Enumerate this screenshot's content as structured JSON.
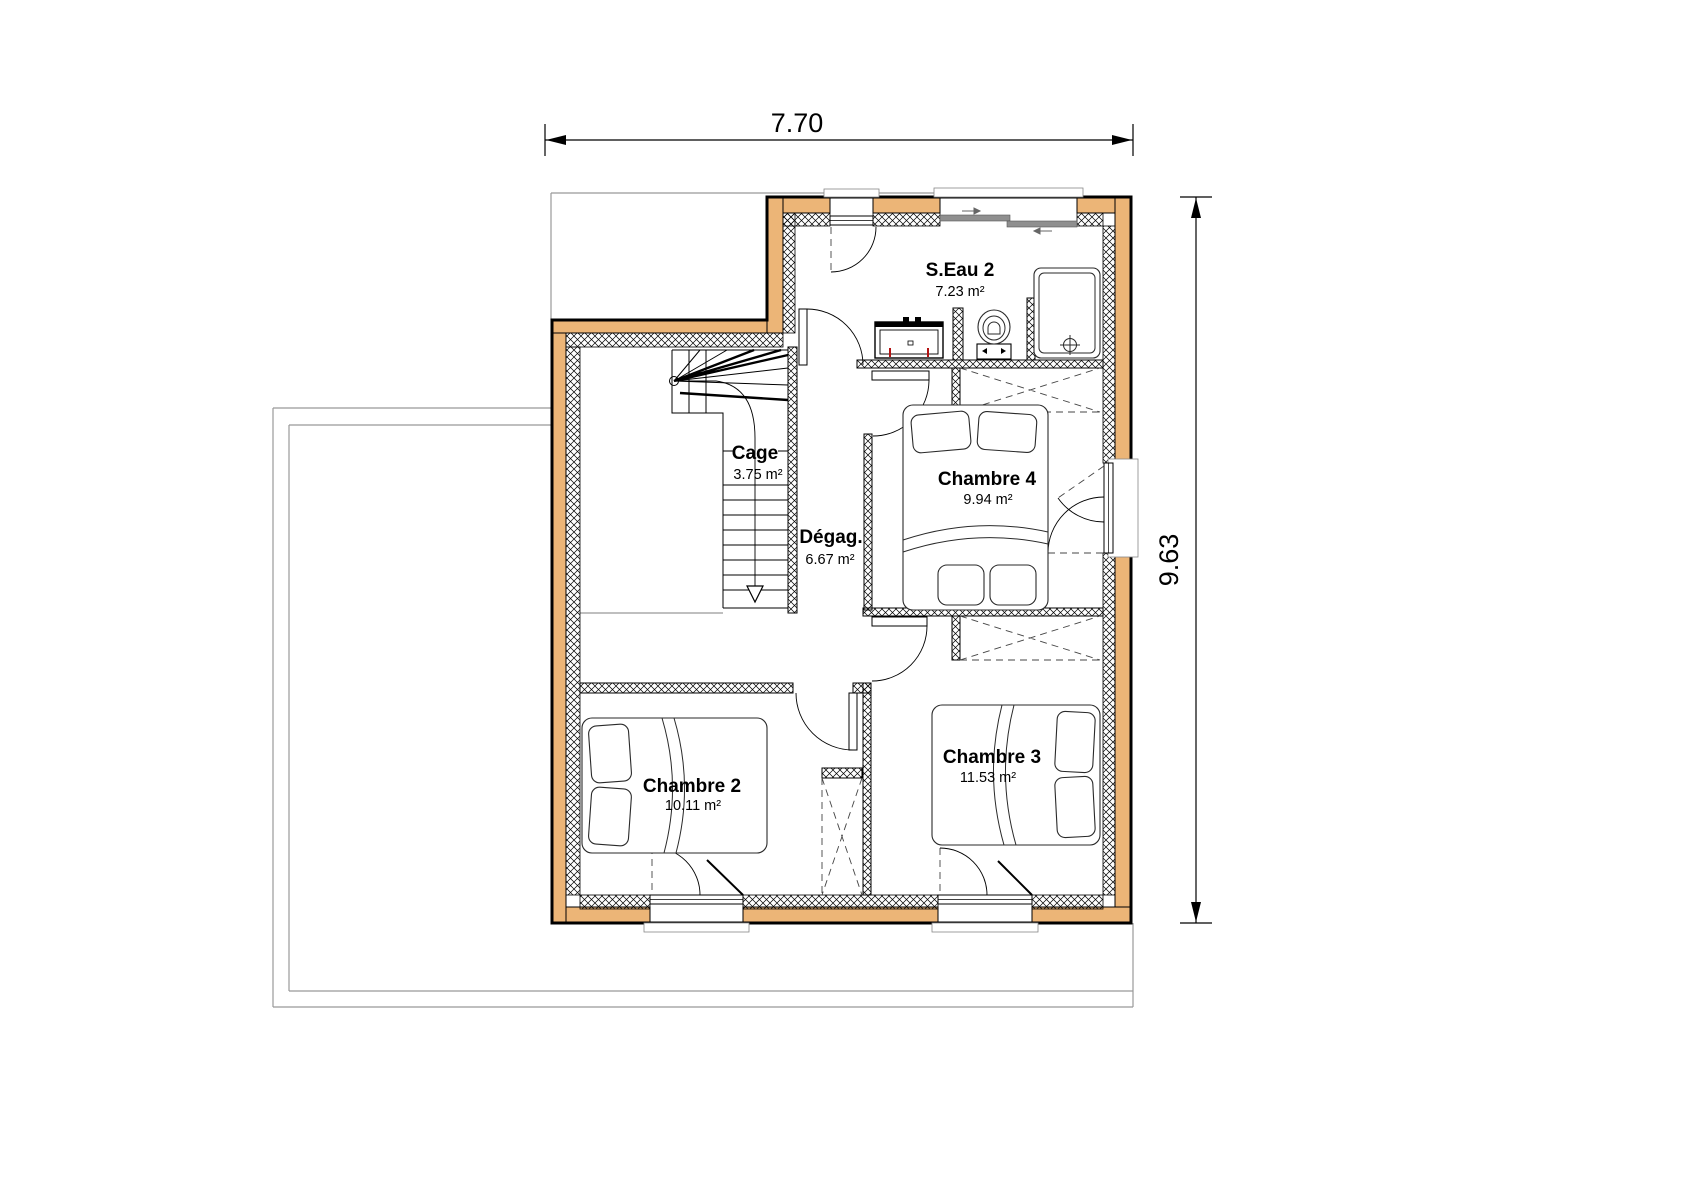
{
  "plan": {
    "title": "floor-plan-upper-storey",
    "dim_top": "7.70",
    "dim_right": "9.63",
    "rooms": [
      {
        "id": "seau2",
        "name": "S.Eau 2",
        "area": "7.23 m²"
      },
      {
        "id": "cage",
        "name": "Cage",
        "area": "3.75 m²"
      },
      {
        "id": "degag",
        "name": "Dégag.",
        "area": "6.67 m²"
      },
      {
        "id": "chambre4",
        "name": "Chambre 4",
        "area": "9.94 m²"
      },
      {
        "id": "chambre2",
        "name": "Chambre 2",
        "area": "10.11 m²"
      },
      {
        "id": "chambre3",
        "name": "Chambre 3",
        "area": "11.53 m²"
      }
    ],
    "colors": {
      "wall_fill": "#ecb577",
      "line": "#000000",
      "roof_outline": "#999999",
      "window_gray": "#8f8f8f",
      "accent_red": "#b31212"
    }
  }
}
